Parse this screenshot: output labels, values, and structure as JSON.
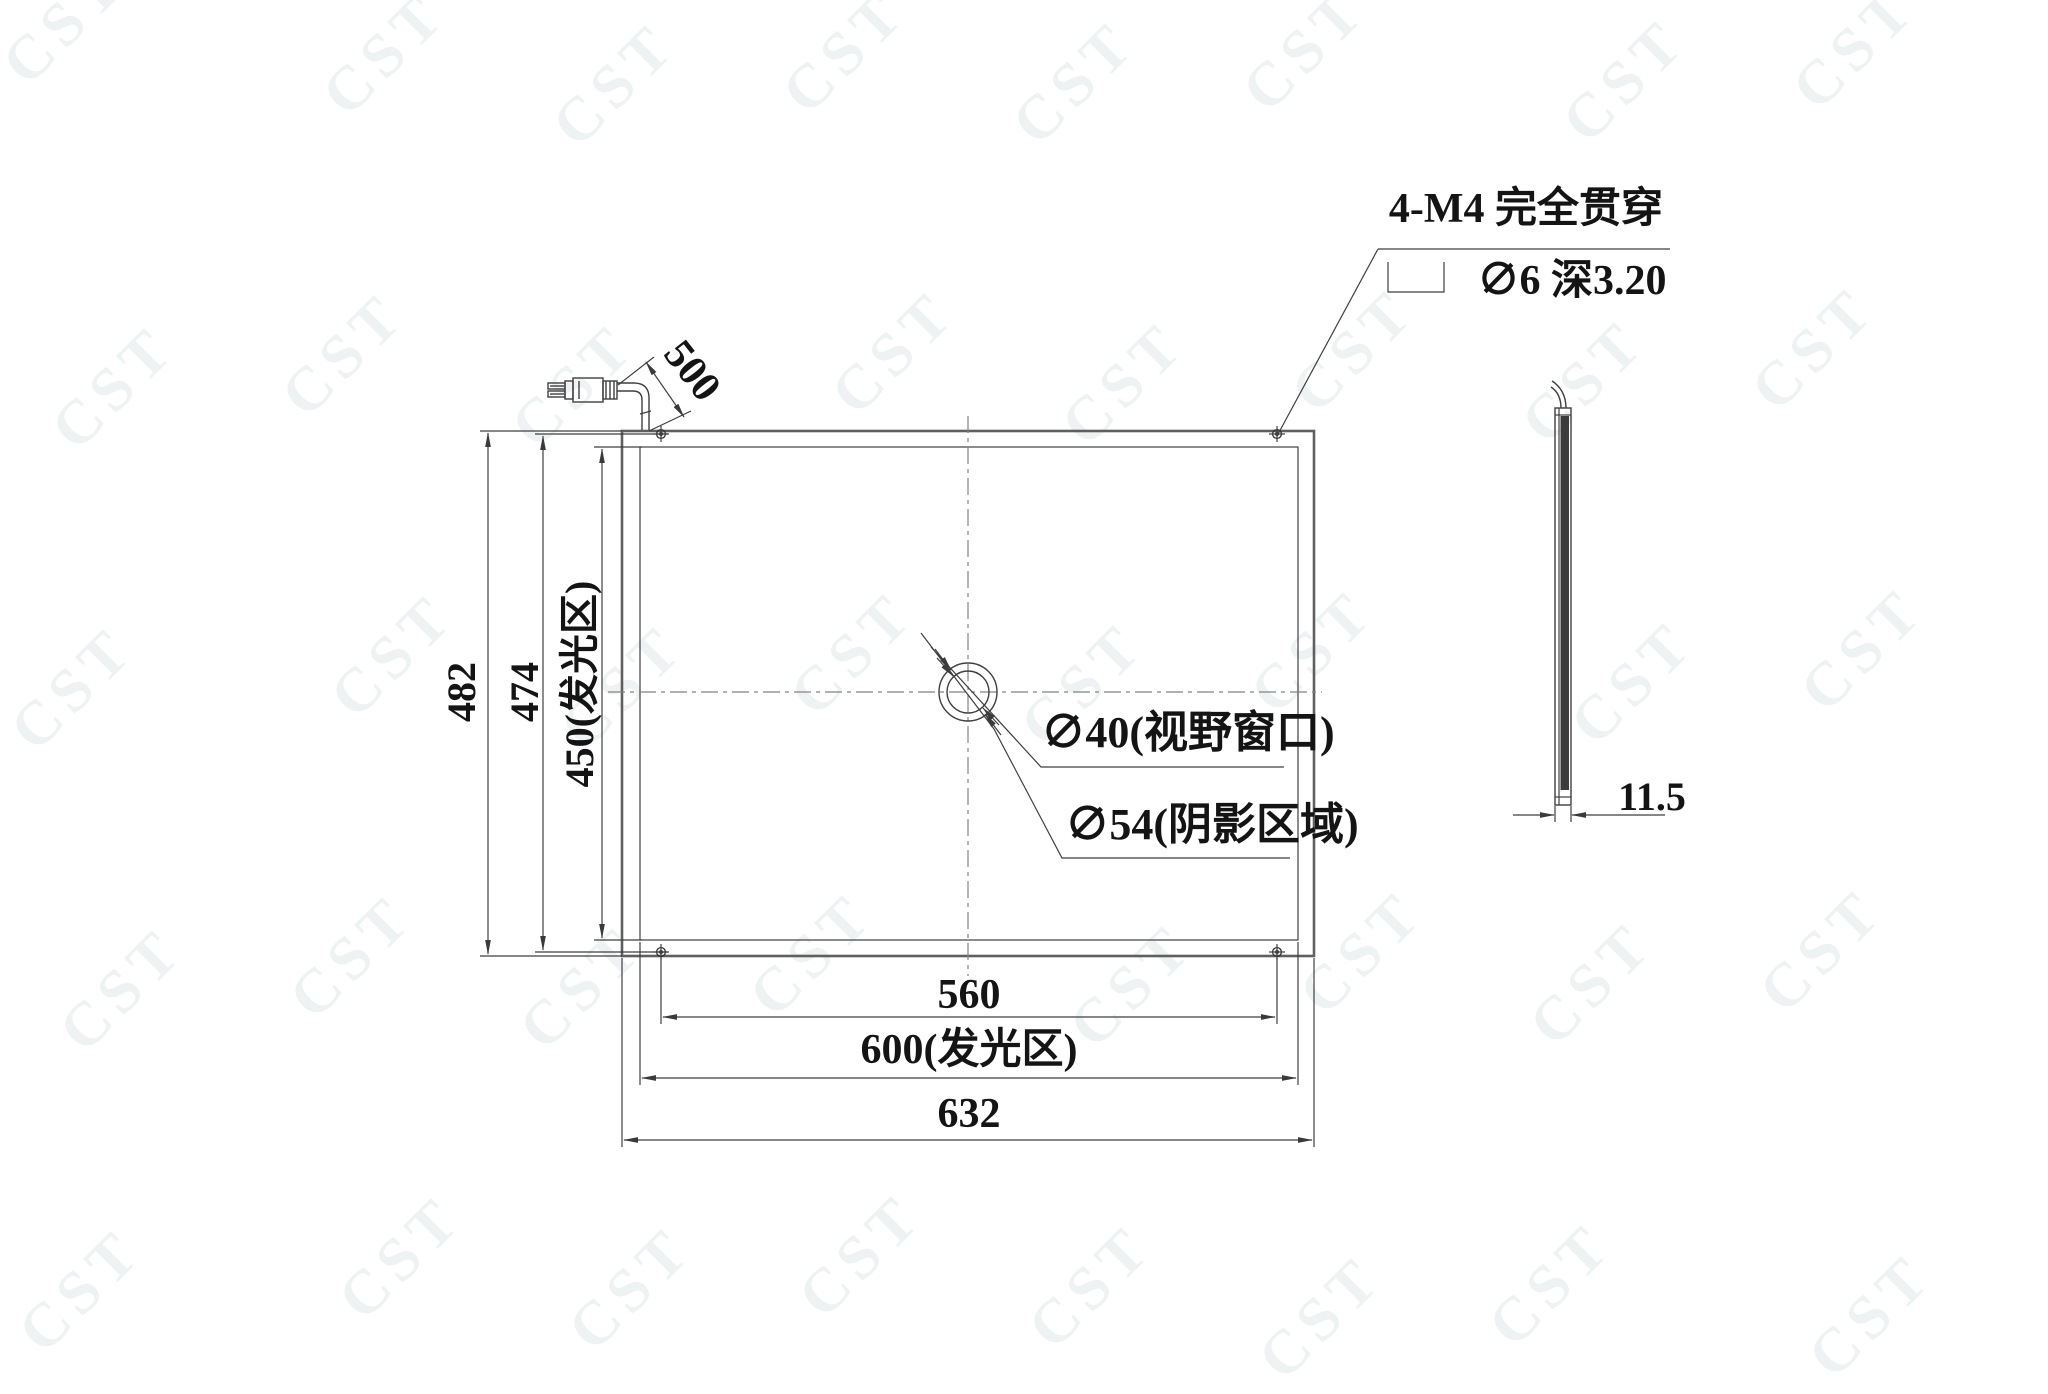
{
  "colors": {
    "line": "#3f3f3f",
    "thick_line": "#5f5f5f",
    "centerline_dash": "#828282",
    "dark_fill": "#3c3c3c",
    "watermark": "#eff2f2",
    "text": "#141414",
    "background": "#ffffff"
  },
  "watermark": {
    "text": "CST",
    "rotation_deg": -45,
    "cols": 8,
    "rows": 5,
    "x_start": 110,
    "y_start": 55,
    "x_step": 247,
    "y_step": 308
  },
  "front_view": {
    "note": {
      "line1": "4-M4 完全贯穿",
      "line2": "∅6 深3.20",
      "symbol": "counterbore-icon"
    },
    "dims": {
      "overall_height": "482",
      "hole_span_height": "474",
      "emitting_height": "450(发光区)",
      "hole_span_width": "560",
      "emitting_width": "600(发光区)",
      "overall_width": "632",
      "cable_length": "500"
    },
    "callouts": {
      "view_window": "∅40(视野窗口)",
      "shadow_area": "∅54(阴影区域)"
    }
  },
  "side_view": {
    "dims": {
      "thickness": "11.5"
    }
  }
}
